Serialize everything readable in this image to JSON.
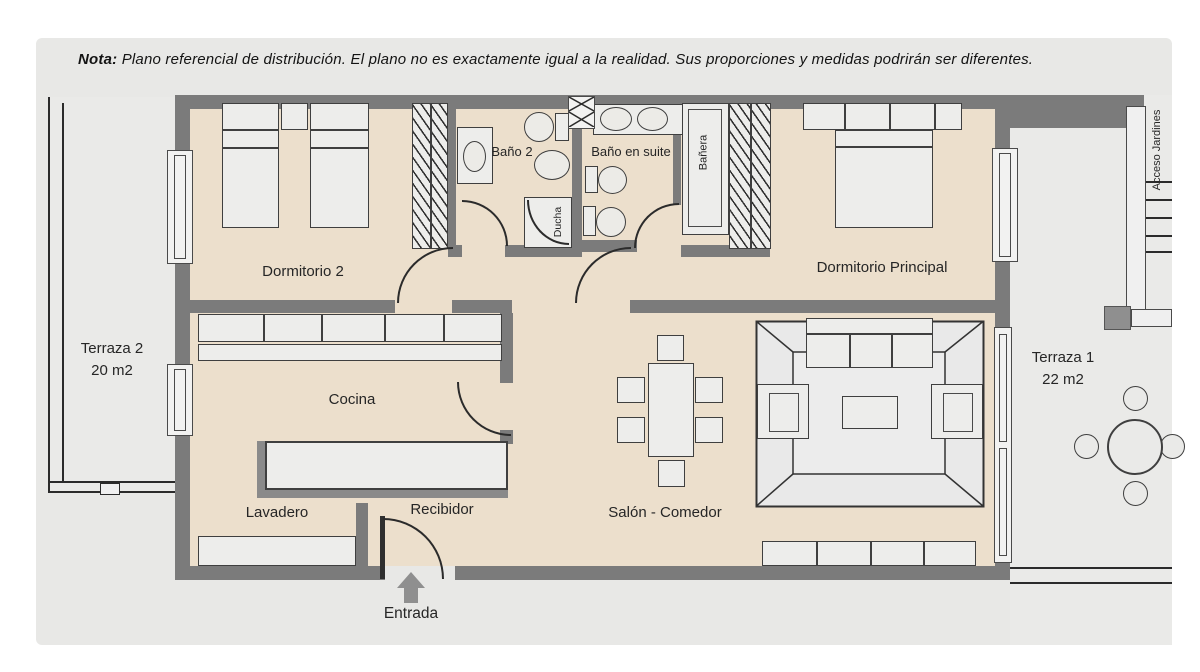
{
  "note": {
    "prefix": "Nota:",
    "text": " Plano referencial de distribución. El plano no es exactamente igual a la realidad. Sus proporciones y medidas podrirán ser diferentes."
  },
  "labels": {
    "dormitorio2": "Dormitorio 2",
    "bano2": "Baño 2",
    "bano_en_suite": "Baño en suite",
    "ducha": "Ducha",
    "banera": "Bañera",
    "dormitorio_principal": "Dormitorio Principal",
    "cocina": "Cocina",
    "lavadero": "Lavadero",
    "recibidor": "Recibidor",
    "salon_comedor": "Salón - Comedor",
    "entrada": "Entrada",
    "acceso_jardines": "Acceso Jardines"
  },
  "terrazas": {
    "terraza1": {
      "name": "Terraza 1",
      "area": "22 m2"
    },
    "terraza2": {
      "name": "Terraza 2",
      "area": "20 m2"
    }
  },
  "colors": {
    "wall": "#7b7b7b",
    "floor": "#ecdfcc",
    "panel": "#e8e8e6",
    "furniture": "#ededeb",
    "terrace": "#eaeae8",
    "line": "#2b2b2b"
  }
}
